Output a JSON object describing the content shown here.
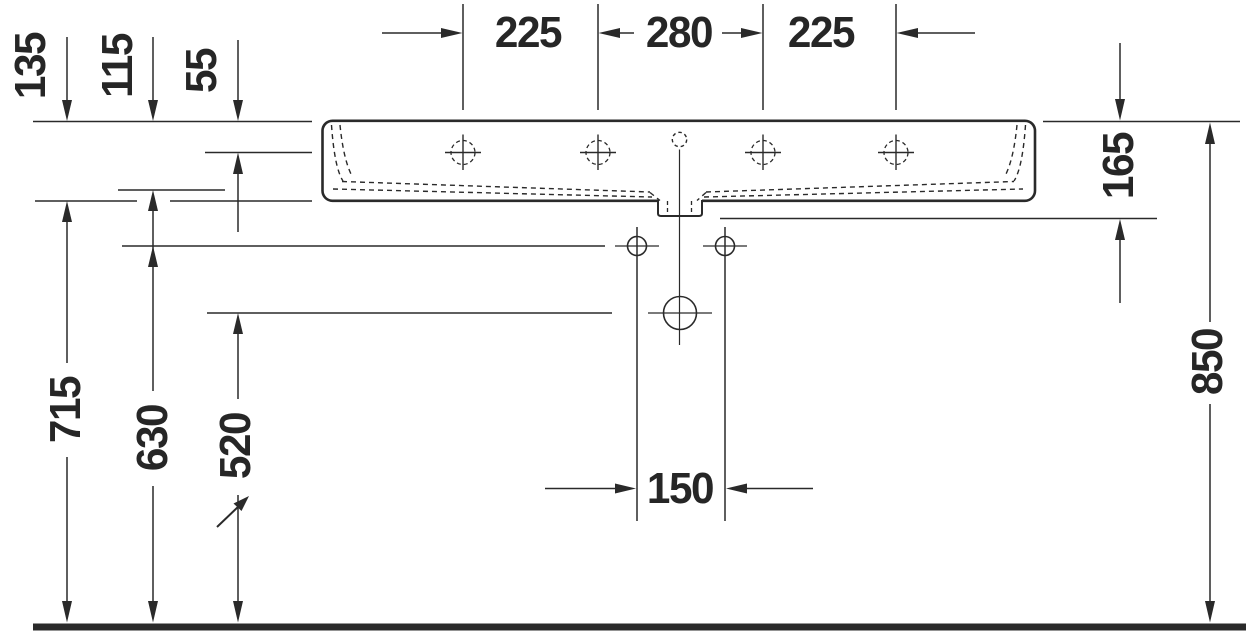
{
  "drawing": {
    "type": "technical-dimension-drawing",
    "subject": "wall-mounted washbasin, front elevation with installation dimensions",
    "units": "mm",
    "colors": {
      "line": "#2a2a2a",
      "text": "#262626",
      "background": "#ffffff"
    },
    "labels": {
      "tap_spacing_left": "225",
      "tap_spacing_center": "280",
      "tap_spacing_right": "225",
      "depth_total": "135",
      "depth_inner": "115",
      "depth_rim": "55",
      "body_height": "165",
      "rim_height_from_floor": "850",
      "body_bottom_height": "715",
      "supply_height": "630",
      "drain_height": "520",
      "supply_spacing": "150"
    }
  }
}
